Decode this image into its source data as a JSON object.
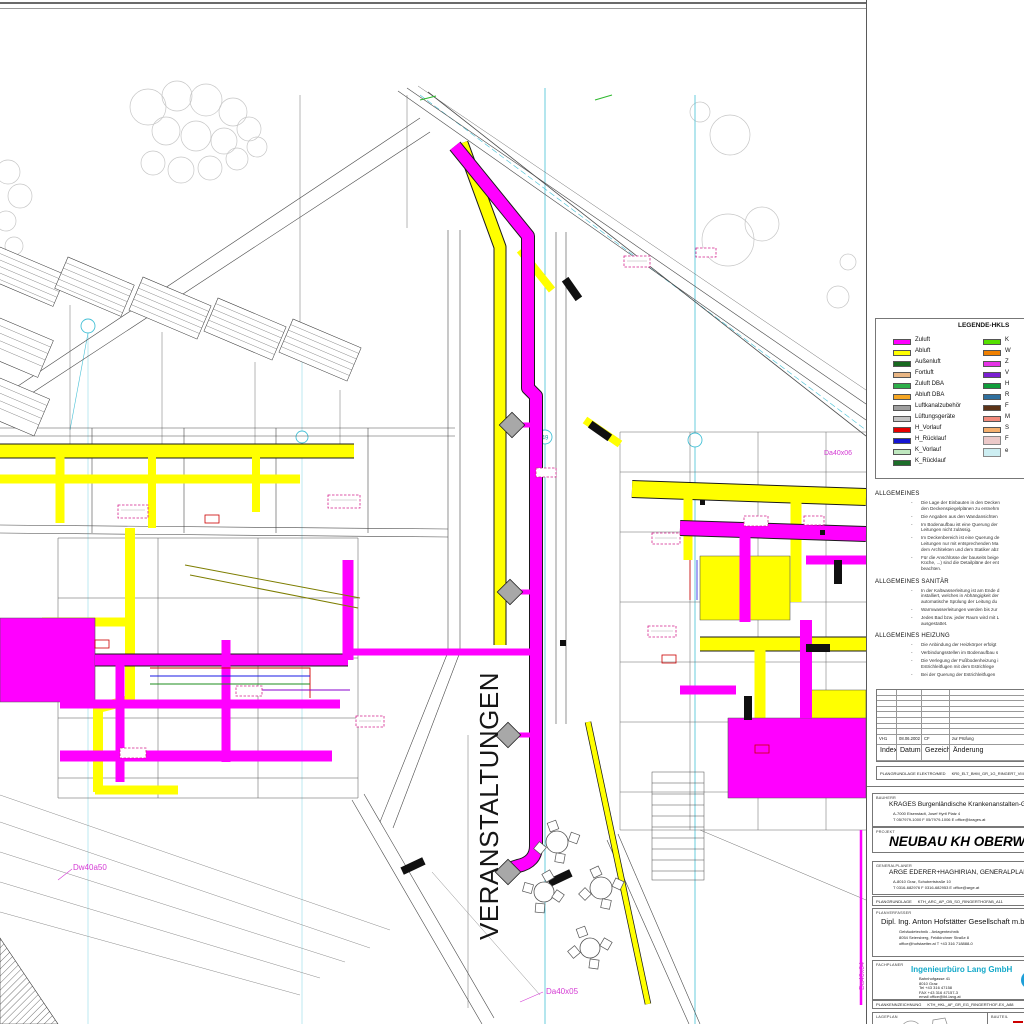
{
  "plan": {
    "veranstaltungen_label": "VERANSTALTUNGEN",
    "labels": {
      "duct_bottom": "Da40x05",
      "duct_left": "Dw40a50",
      "duct_right": "Da40x06",
      "duct_right_vertical": "Da40x04",
      "grid_bubble": "49"
    }
  },
  "legend": {
    "title": "LEGENDE-HKLS",
    "left": [
      {
        "label": "Zuluft",
        "color": "#ff00ff"
      },
      {
        "label": "Abluft",
        "color": "#ffff00"
      },
      {
        "label": "Außenluft",
        "color": "#17691f"
      },
      {
        "label": "Fortluft",
        "color": "#e8b583"
      },
      {
        "label": "Zuluft DBA",
        "color": "#2daf4a"
      },
      {
        "label": "Abluft DBA",
        "color": "#f5a623"
      },
      {
        "label": "Luftkanalzubehör",
        "color": "#9e9e9e"
      },
      {
        "label": "Lüftungsgeräte",
        "color": "#c4c4c4"
      },
      {
        "label": "H_Vorlauf",
        "color": "#e60000"
      },
      {
        "label": "H_Rücklauf",
        "color": "#1414d2"
      },
      {
        "label": "K_Vorlauf",
        "color": "#bfe8bf"
      },
      {
        "label": "K_Rücklauf",
        "color": "#1d6e2a"
      }
    ],
    "right": [
      {
        "label": "K",
        "color": "#55e000"
      },
      {
        "label": "W",
        "color": "#f08000"
      },
      {
        "label": "Z",
        "color": "#e633e6"
      },
      {
        "label": "V",
        "color": "#7a1fd2"
      },
      {
        "label": "H",
        "color": "#0f9d3a"
      },
      {
        "label": "R",
        "color": "#2e6f9e"
      },
      {
        "label": "F",
        "color": "#5c3317"
      },
      {
        "label": "M",
        "color": "#f28b7d"
      },
      {
        "label": "S",
        "color": "#f5b06e"
      },
      {
        "label": "F",
        "color": "#ecc9c9"
      },
      {
        "label": "e",
        "color": "#cdeef2"
      }
    ]
  },
  "notes": {
    "allgemeines": {
      "title": "ALLGEMEINES",
      "items": [
        "Die Lage der Einbauten in den Decken\nden Deckenspiegelplänen zu entnehm",
        "Die Angaben aus den Wandansichten",
        "Im Bodenaufbau ist eine Querung der\nLeitungen nicht zulässig.",
        "Im Deckenbereich ist eine Querung de\nLeitungen nur mit entsprechenden Ma\ndem Architekten und dem Statiker abz",
        "Für die Anschlüsse der bauseits beige\nKüche, ...) sind die Detailpläne der ent\nbeachten."
      ]
    },
    "sanitaer": {
      "title": "ALLGEMEINES SANITÄR",
      "items": [
        "In der Kaltwasserleitung ist am Ende d\ninstalliert, welches in Abhängigkeit der\nautomatische Spülung der Leitung du",
        "Warmwasserleitungen werden bis zur",
        "Jedes Bad bzw. jeder Raum wird mit L\nausgestattet."
      ]
    },
    "heizung": {
      "title": "ALLGEMEINES HEIZUNG",
      "items": [
        "Die Anbindung der Heizkörper erfolgt",
        "Verbindungsstellen im Bodenaufbau s",
        "Die Verlegung der Fußbodenheizung i\nEstrichleitfugen mit dem Estrichlege",
        "Bei der Querung der Estrichleitfugen"
      ]
    }
  },
  "revision": {
    "header": {
      "index": "Index",
      "datum": "Datum",
      "gezeichnet": "Gezeichn.",
      "aenderung": "Änderung"
    },
    "row": {
      "index": "VH1",
      "datum": "08.06.2002",
      "gezeichnet": "CF",
      "aenderung": "zur Prüfung"
    },
    "code_label": "PLANGRUNDLAGE ELEKTRO/MED",
    "code_value": "KR0_ELT_BHM_GR_1G_RINGER7_VIII / 6S"
  },
  "title_block": {
    "bauherr": {
      "label": "BAUHERR",
      "name": "KRAGES Burgenländische Krankenanstalten-Ges.",
      "address": "A-7000 Eisenstadt, Josef Hyrtl Platz 4",
      "contact": "T 05/7979-1000      F 05/7979-1006      E office@krages.at"
    },
    "projekt": {
      "label": "PROJEKT",
      "name": "NEUBAU KH OBERWART"
    },
    "generalplaner": {
      "label": "GENERALPLANER",
      "name": "ARGE EDERER+HAGHIRIAN, GENERALPLAN GMBH",
      "address": "A-8010 Graz, Schubertstraße 10",
      "contact": "T 0316-682976      F 0316-682953      E office@arge.at"
    },
    "plangrundlage": {
      "label": "PLANGRUNDLAGE",
      "value": "KTH_ARC_AP_OB_SO_RINGERTHOFAB_A11"
    },
    "planverfasser": {
      "label": "PLANVERFASSER",
      "name": "Dipl. Ing. Anton Hofstätter Gesellschaft m.b.H.",
      "line1": "Gebäudetechnik - Anlagentechnik",
      "line2": "8054 Seiersberg, Feldkirchner Straße 8",
      "line3": "office@hofstaetter.at        T +43 316 718888-0"
    },
    "fachplaner": {
      "label": "FACHPLANER",
      "name": "Ingenieurbüro Lang GmbH",
      "name_color": "#14a9c9",
      "line1": "Bahnhofgasse            41",
      "line2": "8010                         Graz",
      "line3": "Tel      +43 316 47158",
      "line4": "FAX     +43 316 47157-3",
      "line5": "email   office@ibl-lang.at"
    },
    "plankennzeichnung": {
      "label": "PLANKENNZEICHNUNG",
      "value": "KTH_HKL_AF_GR_EG_RINGERTHOF-EX_A88"
    },
    "lageplan": {
      "label": "LAGEPLAN",
      "bauteil_label": "BAUTEIL"
    }
  }
}
